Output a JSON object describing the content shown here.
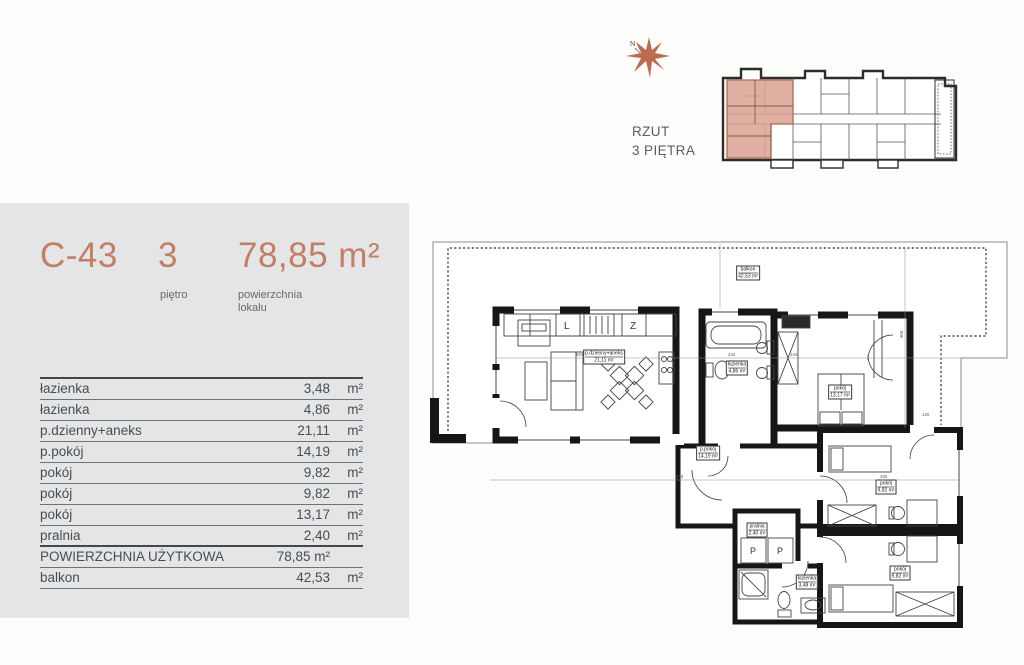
{
  "panel": {
    "unit_id": "C-43",
    "floor_value": "3",
    "floor_label": "piętro",
    "area_value": "78,85 m²",
    "area_label_line1": "powierzchnia",
    "area_label_line2": "lokalu",
    "rooms": [
      {
        "name": "łazienka",
        "area": "3,48",
        "unit": "m²"
      },
      {
        "name": "łazienka",
        "area": "4,86",
        "unit": "m²"
      },
      {
        "name": "p.dzienny+aneks",
        "area": "21,11",
        "unit": "m²"
      },
      {
        "name": "p.pokój",
        "area": "14,19",
        "unit": "m²"
      },
      {
        "name": "pokój",
        "area": "9,82",
        "unit": "m²"
      },
      {
        "name": "pokój",
        "area": "9,82",
        "unit": "m²"
      },
      {
        "name": "pokój",
        "area": "13,17",
        "unit": "m²"
      },
      {
        "name": "pralnia",
        "area": "2,40",
        "unit": "m²"
      },
      {
        "name": "POWIERZCHNIA UŻYTKOWA",
        "area": "78,85 m²",
        "unit": ""
      },
      {
        "name": "balkon",
        "area": "42,53",
        "unit": "m²"
      }
    ]
  },
  "overview": {
    "title_line1": "RZUT",
    "title_line2": "3 PIĘTRA",
    "compass": "N"
  },
  "floorplan": {
    "labels": [
      {
        "name": "balkon",
        "area": "42,53 m²"
      },
      {
        "name": "p.dzienny+aneks",
        "area": "21,11 m²"
      },
      {
        "name": "łazienka",
        "area": "4,86 m²"
      },
      {
        "name": "pokój",
        "area": "13,17 m²"
      },
      {
        "name": "p.pokój",
        "area": "14,19 m²"
      },
      {
        "name": "pralnia",
        "area": "2,40 m²"
      },
      {
        "name": "łazienka",
        "area": "3,48 m²"
      },
      {
        "name": "pokój",
        "area": "9,82 m²"
      },
      {
        "name": "pokój",
        "area": "9,82 m²"
      }
    ],
    "appliances": {
      "fridge": "L",
      "dishwasher": "Z",
      "washer": "P"
    },
    "dimensions": [
      "604",
      "222",
      "244",
      "905",
      "470",
      "325",
      "120"
    ]
  },
  "colors": {
    "accent": "#c57d64",
    "panel_bg": "#e3e5e7",
    "text": "#494d50",
    "wall": "#161616",
    "highlight_fill": "#d9a290",
    "highlight_stroke": "#b16a50"
  }
}
